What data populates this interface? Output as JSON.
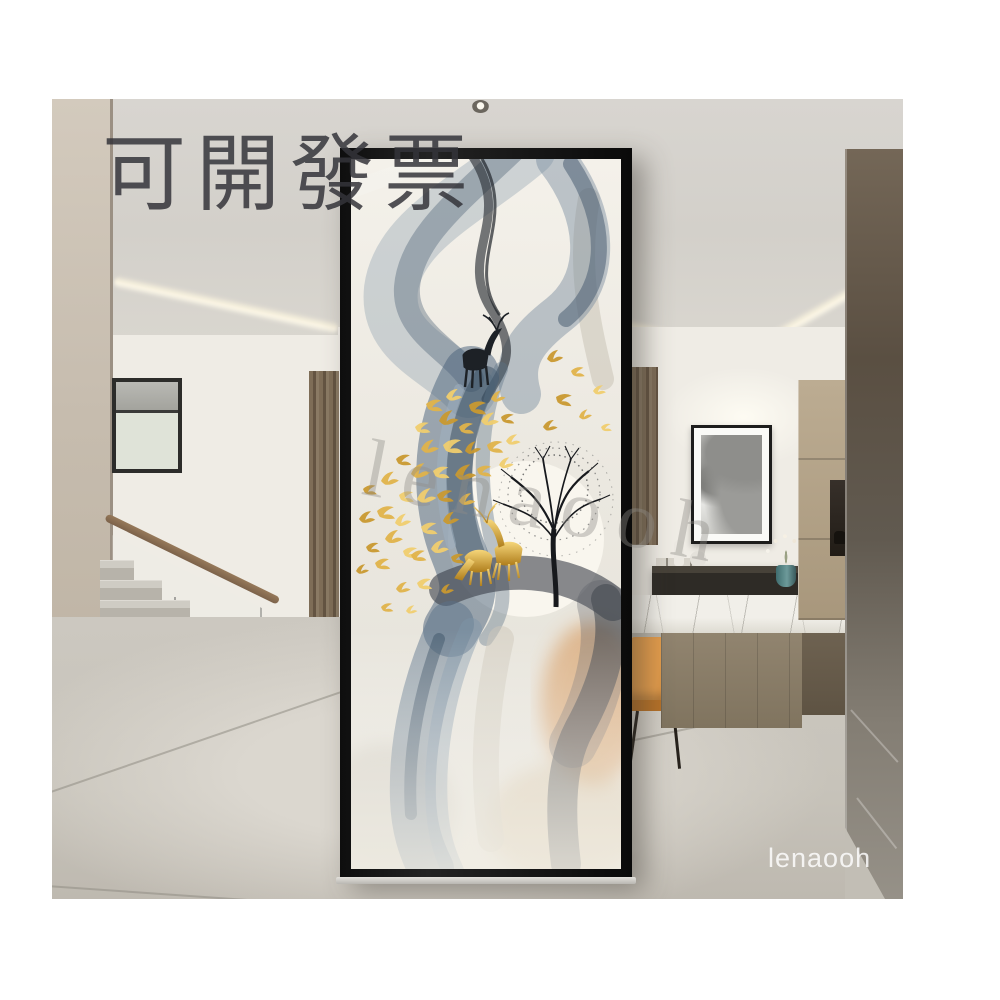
{
  "canvas": {
    "background": "#ffffff"
  },
  "watermarks": {
    "invoice": "可開發票",
    "brand_center": "lenaooh",
    "brand_corner": "lenaooh"
  },
  "palette": {
    "frame_black": "#161616",
    "smoke_blue": "#4a617a",
    "smoke_charcoal": "#31373f",
    "gold_accent": "#d8a83e",
    "chair_orange": "#d2863c",
    "wall_cream": "#efece5",
    "floor_gray": "#c9c5bc",
    "wood_brown": "#7b6a54"
  },
  "glass_art": {
    "motifs": [
      "smoke-ribbons",
      "golden-birds",
      "golden-deer-pair",
      "black-deer-silhouette",
      "bare-tree",
      "moon"
    ]
  }
}
